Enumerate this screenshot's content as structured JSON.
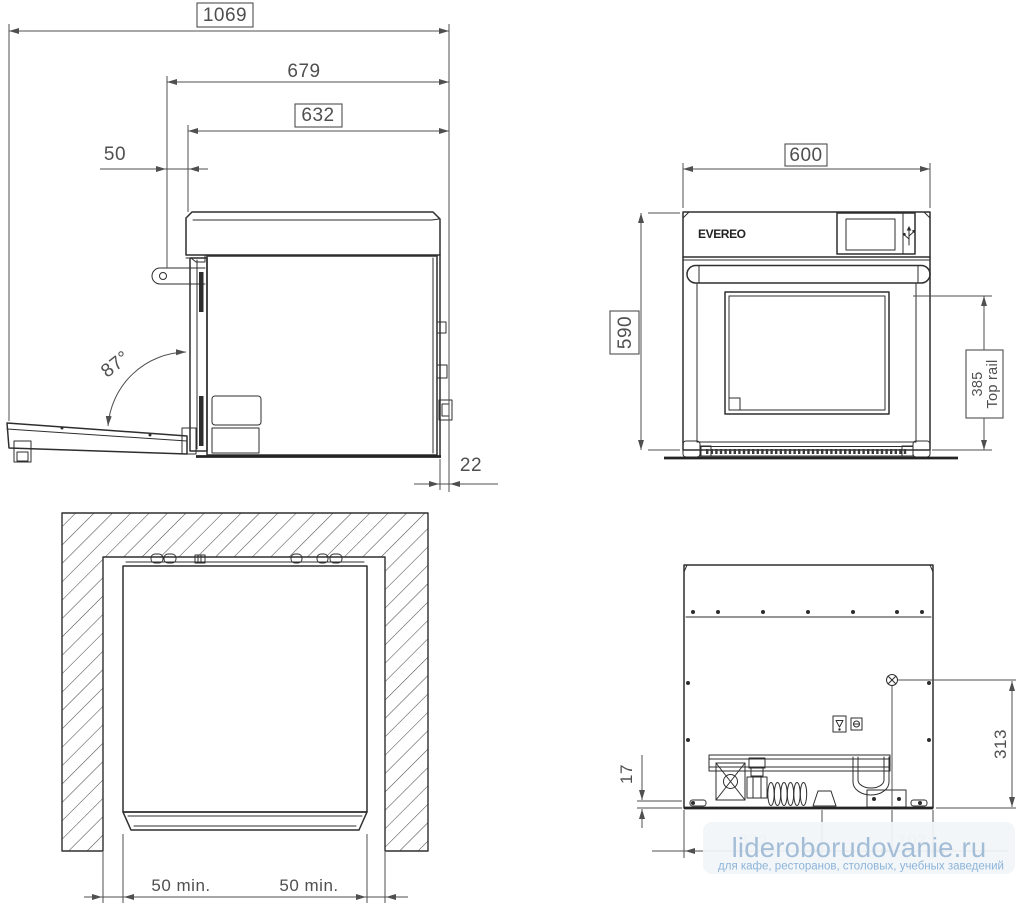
{
  "views": {
    "side": {
      "dims": {
        "overall_depth": "1069",
        "depth_to_door_face": "679",
        "body_depth": "632",
        "front_offset": "50",
        "door_open_angle": "87°",
        "rear_gap": "22"
      }
    },
    "front": {
      "brand_logo": "EVEREO",
      "dims": {
        "width": "600",
        "height": "590",
        "top_rail_height": "385",
        "top_rail_caption": "Top rail"
      }
    },
    "top": {
      "dims": {
        "left_side_clearance": "50 min.",
        "right_side_clearance": "50 min."
      }
    },
    "rear": {
      "dims": {
        "base_strip_height": "17",
        "connection_height": "313",
        "partially_hidden_left": "322",
        "partially_hidden_right": "102"
      }
    }
  },
  "watermark": {
    "title": "lideroborudovanie.ru",
    "subtitle": "для кафе, ресторанов, столовых, учебных заведений",
    "title_color": "#a4bdd7",
    "subtitle_color": "#8db4da",
    "background": "#f1f5f8"
  },
  "colors": {
    "object_line": "#2e2e2e",
    "dimension_line": "#4f4f4f",
    "page_background": "#ffffff"
  }
}
